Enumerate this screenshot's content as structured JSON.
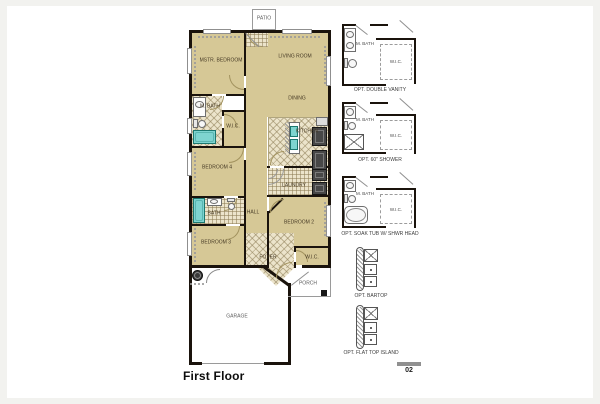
{
  "title_block": {
    "floor_label": "First Floor",
    "sheet_number": "02"
  },
  "colors": {
    "room_fill": "#d6c896",
    "tile_fill": "#ece4cb",
    "wall": "#1a130c",
    "fixture_cyan": "#7ed4d0",
    "appliance_dark": "#474747",
    "detail_gray": "#9a9a9a"
  },
  "plan": {
    "rooms": [
      {
        "label": "MSTR. BEDROOM"
      },
      {
        "label": "LIVING ROOM"
      },
      {
        "label": "DINING"
      },
      {
        "label": "M. BATH"
      },
      {
        "label": "W.I.C."
      },
      {
        "label": "KITCHEN"
      },
      {
        "label": "BEDROOM 4"
      },
      {
        "label": "LAUNDRY"
      },
      {
        "label": "HALL"
      },
      {
        "label": "BATH"
      },
      {
        "label": "BEDROOM 2"
      },
      {
        "label": "BEDROOM 3"
      },
      {
        "label": "FOYER"
      },
      {
        "label": "W.I.C."
      },
      {
        "label": "PORCH"
      },
      {
        "label": "GARAGE"
      },
      {
        "label": "PATIO"
      }
    ]
  },
  "options": [
    {
      "caption": "OPT. DOUBLE VANITY",
      "bath_label": "M. BATH",
      "closet_label": "W.I.C."
    },
    {
      "caption": "OPT. 60\" SHOWER",
      "bath_label": "M. BATH",
      "closet_label": "W.I.C."
    },
    {
      "caption": "OPT. SOAK TUB W/ SHWR HEAD",
      "bath_label": "M. BATH",
      "closet_label": "W.I.C."
    },
    {
      "caption": "OPT. BARTOP"
    },
    {
      "caption": "OPT. FLAT TOP ISLAND"
    }
  ]
}
